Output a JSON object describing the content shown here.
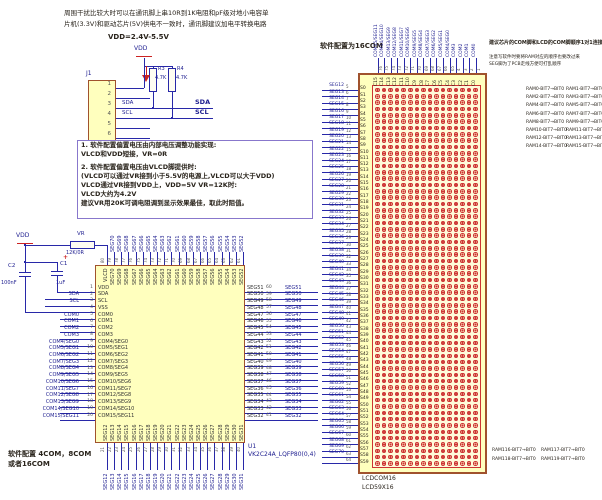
{
  "colors": {
    "wire": "#2828a8",
    "net_label": "#1d1d8f",
    "part_fill": "#ffffbe",
    "part_border": "#a0522d",
    "dot_red": "#cc3333",
    "note_border": "#8877cc",
    "accent_red": "#cc2222"
  },
  "top_note": {
    "line1": "周围干扰比较大时可以在通讯脚上串10R到1K电阻和pF级对地小电容单",
    "line2": "片机(3.3V)和驱动芯片(5V)供电不一致时，通讯脚建议加电平转换电路",
    "vdd_range": "VDD=2.4V-5.5V"
  },
  "mcu": {
    "ref": "J1",
    "name": "MCU_CONNECT",
    "vdd": "VDD",
    "pins": [
      "1",
      "2",
      "3",
      "4",
      "5",
      "6"
    ],
    "sda_small": "SDA",
    "scl_small": "SCL",
    "sda_bold": "SDA",
    "scl_bold": "SCL",
    "r3_ref": "R3",
    "r3_val": "4.7K",
    "r4_ref": "R4",
    "r4_val": "4.7K"
  },
  "bias_note": {
    "lines": [
      "1. 软件配置偏置电压由内部电压调整功能实现:",
      "VLCD和VDD短接，VR=0R",
      "2. 软件配置偏置电压由VLCD脚提供时:",
      "(VLCD可以通过VR接到小于5.5V的电源上,VLCD可以大于VDD)",
      "VLCD通过VR接到VDD上，VDD=5V VR=12K时:",
      "VLCD大约为4.2V",
      "建议VR用20K可调电阻调到显示效果最佳，取此时阻值。"
    ]
  },
  "supply": {
    "vdd": "VDD",
    "vr_ref": "VR",
    "vr_val": "12K/0R",
    "c2_ref": "C2",
    "c2_val": "100nF",
    "c1_ref": "C1",
    "c1_val": "1uF",
    "plus": "+"
  },
  "com_note": {
    "line1": "软件配置 4COM，8COM",
    "line2": "或者16COM"
  },
  "chip": {
    "ref": "U1",
    "part": "VK2C24A_LQFP80(0,4)",
    "left": [
      [
        "",
        "1",
        "VDD"
      ],
      [
        "SDA",
        "2",
        "SDA"
      ],
      [
        "SCL",
        "3",
        "SCL"
      ],
      [
        "",
        "4",
        "VSS"
      ],
      [
        "COM0",
        "5",
        "COM0"
      ],
      [
        "COM1",
        "6",
        "COM1"
      ],
      [
        "COM2",
        "7",
        "COM2"
      ],
      [
        "COM3",
        "8",
        "COM3"
      ],
      [
        "COM4/SEG0",
        "9",
        "COM4/SEG0"
      ],
      [
        "COM5/SEG1",
        "10",
        "COM5/SEG1"
      ],
      [
        "COM6/SEG2",
        "11",
        "COM6/SEG2"
      ],
      [
        "COM7/SEG3",
        "12",
        "COM7/SEG3"
      ],
      [
        "COM8/SEG4",
        "13",
        "COM8/SEG4"
      ],
      [
        "COM9/SEG5",
        "14",
        "COM9/SEG5"
      ],
      [
        "COM10/SEG6",
        "15",
        "COM10/SEG6"
      ],
      [
        "COM11/SEG7",
        "16",
        "COM11/SEG7"
      ],
      [
        "COM12/SEG8",
        "17",
        "COM12/SEG8"
      ],
      [
        "COM13/SEG9",
        "18",
        "COM13/SEG9"
      ],
      [
        "COM14/SEG10",
        "19",
        "COM14/SEG10"
      ],
      [
        "COM15/SEG11",
        "20",
        "COM15/SEG11"
      ]
    ],
    "top": [
      [
        "",
        "80",
        "VLCD"
      ],
      [
        "SEG70",
        "79",
        "SEG70"
      ],
      [
        "SEG69",
        "78",
        "SEG69"
      ],
      [
        "SEG68",
        "77",
        "SEG68"
      ],
      [
        "SEG67",
        "76",
        "SEG67"
      ],
      [
        "SEG66",
        "75",
        "SEG66"
      ],
      [
        "SEG65",
        "74",
        "SEG65"
      ],
      [
        "SEG64",
        "73",
        "SEG64"
      ],
      [
        "SEG63",
        "72",
        "SEG63"
      ],
      [
        "SEG62",
        "71",
        "SEG62"
      ],
      [
        "SEG61",
        "70",
        "SEG61"
      ],
      [
        "SEG60",
        "69",
        "SEG60"
      ],
      [
        "SEG59",
        "68",
        "SEG59"
      ],
      [
        "SEG58",
        "67",
        "SEG58"
      ],
      [
        "SEG57",
        "66",
        "SEG57"
      ],
      [
        "SEG56",
        "65",
        "SEG56"
      ],
      [
        "SEG55",
        "64",
        "SEG55"
      ],
      [
        "SEG54",
        "63",
        "SEG54"
      ],
      [
        "SEG53",
        "62",
        "SEG53"
      ],
      [
        "SEG52",
        "61",
        "SEG52"
      ]
    ],
    "right": [
      [
        "SEG51",
        "60",
        "SEG51"
      ],
      [
        "SEG50",
        "59",
        "SEG50"
      ],
      [
        "SEG49",
        "58",
        "SEG49"
      ],
      [
        "SEG48",
        "57",
        "SEG48"
      ],
      [
        "SEG47",
        "56",
        "SEG47"
      ],
      [
        "SEG46",
        "55",
        "SEG46"
      ],
      [
        "SEG45",
        "54",
        "SEG45"
      ],
      [
        "SEG44",
        "53",
        "SEG44"
      ],
      [
        "SEG43",
        "52",
        "SEG43"
      ],
      [
        "SEG42",
        "51",
        "SEG42"
      ],
      [
        "SEG41",
        "50",
        "SEG41"
      ],
      [
        "SEG40",
        "49",
        "SEG40"
      ],
      [
        "SEG39",
        "48",
        "SEG39"
      ],
      [
        "SEG38",
        "47",
        "SEG38"
      ],
      [
        "SEG37",
        "46",
        "SEG37"
      ],
      [
        "SEG36",
        "45",
        "SEG36"
      ],
      [
        "SEG35",
        "44",
        "SEG35"
      ],
      [
        "SEG34",
        "43",
        "SEG34"
      ],
      [
        "SEG33",
        "42",
        "SEG33"
      ],
      [
        "SEG32",
        "41",
        "SEG32"
      ]
    ],
    "bottom": [
      [
        "SEG12",
        "21",
        "SEG12"
      ],
      [
        "SEG13",
        "22",
        "SEG13"
      ],
      [
        "SEG14",
        "23",
        "SEG14"
      ],
      [
        "SEG15",
        "24",
        "SEG15"
      ],
      [
        "SEG16",
        "25",
        "SEG16"
      ],
      [
        "SEG17",
        "26",
        "SEG17"
      ],
      [
        "SEG18",
        "27",
        "SEG18"
      ],
      [
        "SEG19",
        "28",
        "SEG19"
      ],
      [
        "SEG20",
        "29",
        "SEG20"
      ],
      [
        "SEG21",
        "30",
        "SEG21"
      ],
      [
        "SEG22",
        "31",
        "SEG22"
      ],
      [
        "SEG23",
        "32",
        "SEG23"
      ],
      [
        "SEG24",
        "33",
        "SEG24"
      ],
      [
        "SEG25",
        "34",
        "SEG25"
      ],
      [
        "SEG26",
        "35",
        "SEG26"
      ],
      [
        "SEG27",
        "36",
        "SEG27"
      ],
      [
        "SEG28",
        "37",
        "SEG28"
      ],
      [
        "SEG29",
        "38",
        "SEG29"
      ],
      [
        "SEG30",
        "39",
        "SEG30"
      ],
      [
        "SEG31",
        "40",
        "SEG31"
      ]
    ]
  },
  "lcd": {
    "title": "软件配置为16COM",
    "note1": "建议芯片的COM脚和LCD的COM脚顺序1对1连接",
    "note2": "注意写软件时要将RAM对应的顺序也要改过来",
    "note3": "SEG脚为了PCB走线方便可打乱顺序",
    "name1": "LCDCOM16",
    "name2": "LCD59X16",
    "cols": [
      [
        "COM15/SEG11",
        "76",
        "C15"
      ],
      [
        "COM14/SEG10",
        "75",
        "C14"
      ],
      [
        "COM13/SEG9",
        "74",
        "C13"
      ],
      [
        "COM12/SEG8",
        "73",
        "C12"
      ],
      [
        "COM11/SEG7",
        "72",
        "C11"
      ],
      [
        "COM10/SEG6",
        "71",
        "C10"
      ],
      [
        "COM9/SEG5",
        "70",
        "C9"
      ],
      [
        "COM8/SEG4",
        "69",
        "C8"
      ],
      [
        "COM7/SEG3",
        "68",
        "C7"
      ],
      [
        "COM6/SEG2",
        "67",
        "C6"
      ],
      [
        "COM5/SEG1",
        "66",
        "C5"
      ],
      [
        "COM4/SEG0",
        "65",
        "C4"
      ],
      [
        "COM3",
        "4",
        "C3"
      ],
      [
        "COM2",
        "3",
        "C2"
      ],
      [
        "COM1",
        "2",
        "C1"
      ],
      [
        "COM0",
        "1",
        "C0"
      ]
    ],
    "rows": [
      [
        "SEG12",
        "5",
        "S0"
      ],
      [
        "SEG13",
        "6",
        "S1"
      ],
      [
        "SEG14",
        "7",
        "S2"
      ],
      [
        "SEG15",
        "8",
        "S3"
      ],
      [
        "SEG16",
        "9",
        "S4"
      ],
      [
        "SEG17",
        "10",
        "S5"
      ],
      [
        "SEG18",
        "11",
        "S6"
      ],
      [
        "SEG19",
        "12",
        "S7"
      ],
      [
        "SEG20",
        "13",
        "S8"
      ],
      [
        "SEG21",
        "14",
        "S9"
      ],
      [
        "SEG22",
        "15",
        "S10"
      ],
      [
        "SEG23",
        "16",
        "S11"
      ],
      [
        "SEG24",
        "17",
        "S12"
      ],
      [
        "SEG25",
        "18",
        "S13"
      ],
      [
        "SEG26",
        "19",
        "S14"
      ],
      [
        "SEG27",
        "20",
        "S15"
      ],
      [
        "SEG28",
        "21",
        "S16"
      ],
      [
        "SEG29",
        "22",
        "S17"
      ],
      [
        "SEG30",
        "23",
        "S18"
      ],
      [
        "SEG31",
        "24",
        "S19"
      ],
      [
        "SEG32",
        "25",
        "S20"
      ],
      [
        "SEG33",
        "26",
        "S21"
      ],
      [
        "SEG34",
        "27",
        "S22"
      ],
      [
        "SEG35",
        "28",
        "S23"
      ],
      [
        "SEG36",
        "29",
        "S24"
      ],
      [
        "SEG37",
        "30",
        "S25"
      ],
      [
        "SEG38",
        "31",
        "S26"
      ],
      [
        "SEG39",
        "32",
        "S27"
      ],
      [
        "SEG40",
        "33",
        "S28"
      ],
      [
        "SEG41",
        "34",
        "S29"
      ],
      [
        "SEG42",
        "35",
        "S30"
      ],
      [
        "SEG43",
        "36",
        "S31"
      ],
      [
        "SEG44",
        "37",
        "S32"
      ],
      [
        "SEG45",
        "38",
        "S33"
      ],
      [
        "SEG46",
        "39",
        "S34"
      ],
      [
        "SEG47",
        "40",
        "S35"
      ],
      [
        "SEG48",
        "41",
        "S36"
      ],
      [
        "SEG49",
        "42",
        "S37"
      ],
      [
        "SEG50",
        "43",
        "S38"
      ],
      [
        "SEG51",
        "44",
        "S39"
      ],
      [
        "SEG52",
        "45",
        "S40"
      ],
      [
        "SEG53",
        "46",
        "S41"
      ],
      [
        "SEG54",
        "47",
        "S42"
      ],
      [
        "SEG55",
        "48",
        "S43"
      ],
      [
        "SEG56",
        "49",
        "S44"
      ],
      [
        "SEG57",
        "50",
        "S45"
      ],
      [
        "SEG58",
        "51",
        "S46"
      ],
      [
        "SEG59",
        "52",
        "S47"
      ],
      [
        "SEG60",
        "53",
        "S48"
      ],
      [
        "SEG61",
        "54",
        "S49"
      ],
      [
        "SEG62",
        "55",
        "S50"
      ],
      [
        "SEG63",
        "56",
        "S51"
      ],
      [
        "SEG64",
        "57",
        "S52"
      ],
      [
        "SEG65",
        "58",
        "S53"
      ],
      [
        "SEG66",
        "59",
        "S54"
      ],
      [
        "SEG67",
        "60",
        "S55"
      ],
      [
        "SEG68",
        "61",
        "S56"
      ],
      [
        "SEG69",
        "62",
        "S57"
      ],
      [
        "SEG70",
        "63",
        "S58"
      ],
      [
        "",
        "64",
        "S59"
      ]
    ],
    "ram_top_left": [
      "RAM0-BIT7→BIT0",
      "RAM2-BIT7→BIT0",
      "RAM4-BIT7→BIT0",
      "RAM6-BIT7→BIT0",
      "RAM8-BIT7→BIT0",
      "RAM10-BIT7→BIT0",
      "RAM12-BIT7→BIT0",
      "RAM14-BIT7→BIT0"
    ],
    "ram_top_right": [
      "RAM1-BIT7→BIT0",
      "RAM3-BIT7→BIT0",
      "RAM5-BIT7→BIT0",
      "RAM7-BIT7→BIT0",
      "RAM9-BIT7→BIT0",
      "RAM11-BIT7→BIT0",
      "RAM13-BIT7→BIT0",
      "RAM15-BIT7→BIT0"
    ],
    "ram_bottom": [
      [
        "RAM116-BIT7→BIT0",
        "RAM117-BIT7→BIT0"
      ],
      [
        "RAM118-BIT7→BIT0",
        "RAM119-BIT7→BIT0"
      ]
    ]
  }
}
